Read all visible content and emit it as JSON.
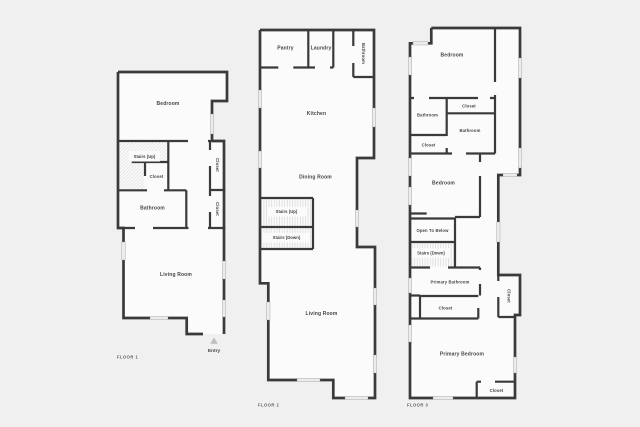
{
  "colors": {
    "bg": "#f0f0f1",
    "room": "#fbfbfb",
    "wall": "#3a3a3a",
    "window": "#ececec",
    "label": "#454545",
    "caption": "#5c5c5c",
    "arrow": "#bdbdbd",
    "hatch": "#d8d8d8",
    "tread": "#cfcfcf"
  },
  "floors": [
    {
      "caption": "FLOOR 1",
      "rooms": {
        "bedroom": "Bedroom",
        "stairs_up": "Stairs (Up)",
        "closet": "Closet",
        "closet_upper": "Closet",
        "bathroom": "Bathroom",
        "closet_lower": "Closet",
        "living_room": "Living Room"
      },
      "entry_label": "Entry"
    },
    {
      "caption": "FLOOR 2",
      "rooms": {
        "pantry": "Pantry",
        "laundry": "Laundry",
        "bathroom": "Bathroom",
        "kitchen": "Kitchen",
        "dining_room": "Dining Room",
        "stairs_up": "Stairs (Up)",
        "stairs_down": "Stairs (Down)",
        "living_room": "Living Room"
      }
    },
    {
      "caption": "FLOOR 3",
      "rooms": {
        "bedroom_top": "Bedroom",
        "closet_top": "Closet",
        "bathroom_left": "Bathroom",
        "bathroom_right": "Bathroom",
        "closet_left": "Closet",
        "bedroom_middle": "Bedroom",
        "open_to_below": "Open To Below",
        "stairs_down": "Stairs (Down)",
        "primary_bathroom": "Primary Bathroom",
        "closet_middle": "Closet",
        "closet_right": "Closet",
        "primary_bedroom": "Primary Bedroom",
        "closet_bottom": "Closet"
      }
    }
  ]
}
